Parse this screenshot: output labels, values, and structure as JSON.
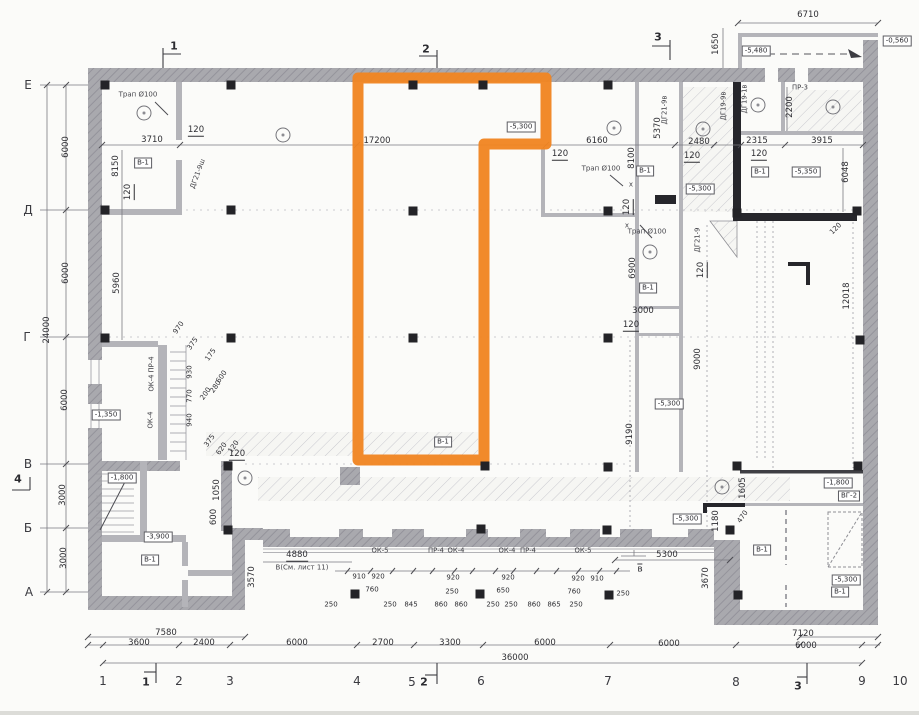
{
  "colors": {
    "paper": "#fbfbf9",
    "wall": "#a8a8ad",
    "wall_dark": "#26262b",
    "line": "#7a7a80",
    "hatch": "#c3c3c9",
    "highlight": "#f08522",
    "ink": "#2e2e33"
  },
  "highlight": {
    "points": "358,78 546,78 546,144 484,144 484,460 358,460"
  },
  "axes": {
    "left": [
      {
        "t": "Е",
        "x": 28,
        "y": 85
      },
      {
        "t": "Д",
        "x": 28,
        "y": 210
      },
      {
        "t": "Г",
        "x": 27,
        "y": 337
      },
      {
        "t": "В",
        "x": 28,
        "y": 464
      },
      {
        "t": "Б",
        "x": 28,
        "y": 528
      },
      {
        "t": "А",
        "x": 29,
        "y": 592
      }
    ],
    "bottom": [
      {
        "t": "1",
        "x": 103,
        "y": 681
      },
      {
        "t": "2",
        "x": 179,
        "y": 681
      },
      {
        "t": "3",
        "x": 230,
        "y": 681
      },
      {
        "t": "4",
        "x": 357,
        "y": 681
      },
      {
        "t": "5",
        "x": 412,
        "y": 682
      },
      {
        "t": "6",
        "x": 481,
        "y": 681
      },
      {
        "t": "7",
        "x": 608,
        "y": 681
      },
      {
        "t": "8",
        "x": 736,
        "y": 682
      },
      {
        "t": "9",
        "x": 862,
        "y": 681
      },
      {
        "t": "10",
        "x": 900,
        "y": 681
      }
    ]
  },
  "labels": [
    {
      "t": "1",
      "x": 174,
      "y": 46,
      "s": "mk"
    },
    {
      "t": "2",
      "x": 426,
      "y": 49,
      "s": "mk"
    },
    {
      "t": "3",
      "x": 658,
      "y": 37,
      "s": "mk"
    },
    {
      "t": "4",
      "x": 18,
      "y": 479,
      "s": "mk"
    },
    {
      "t": "1",
      "x": 146,
      "y": 682,
      "s": "mk"
    },
    {
      "t": "2",
      "x": 424,
      "y": 682,
      "s": "mk"
    },
    {
      "t": "3",
      "x": 798,
      "y": 686,
      "s": "mk"
    },
    {
      "t": "в",
      "x": 640,
      "y": 569,
      "s": "ms"
    },
    {
      "t": "6710",
      "x": 808,
      "y": 15,
      "s": "d"
    },
    {
      "t": "3710",
      "x": 152,
      "y": 140,
      "s": "d"
    },
    {
      "t": "17200",
      "x": 377,
      "y": 141,
      "s": "d"
    },
    {
      "t": "6160",
      "x": 597,
      "y": 141,
      "s": "d"
    },
    {
      "t": "2480",
      "x": 699,
      "y": 142,
      "s": "d"
    },
    {
      "t": "2315",
      "x": 757,
      "y": 141,
      "s": "d"
    },
    {
      "t": "3915",
      "x": 822,
      "y": 141,
      "s": "d"
    },
    {
      "t": "3000",
      "x": 643,
      "y": 311,
      "s": "d"
    },
    {
      "t": "7580",
      "x": 166,
      "y": 633,
      "s": "d"
    },
    {
      "t": "3600",
      "x": 139,
      "y": 643,
      "s": "d"
    },
    {
      "t": "2400",
      "x": 204,
      "y": 643,
      "s": "d"
    },
    {
      "t": "6000",
      "x": 297,
      "y": 643,
      "s": "d"
    },
    {
      "t": "2700",
      "x": 383,
      "y": 643,
      "s": "d"
    },
    {
      "t": "3300",
      "x": 450,
      "y": 643,
      "s": "d"
    },
    {
      "t": "6000",
      "x": 545,
      "y": 643,
      "s": "d"
    },
    {
      "t": "6000",
      "x": 669,
      "y": 644,
      "s": "d"
    },
    {
      "t": "7120",
      "x": 803,
      "y": 634,
      "s": "d"
    },
    {
      "t": "6000",
      "x": 806,
      "y": 646,
      "s": "d"
    },
    {
      "t": "36000",
      "x": 515,
      "y": 658,
      "s": "d"
    },
    {
      "t": "4880",
      "x": 297,
      "y": 556,
      "s": "du"
    },
    {
      "t": "5300",
      "x": 667,
      "y": 555,
      "s": "d"
    },
    {
      "t": "120",
      "x": 196,
      "y": 131,
      "s": "du"
    },
    {
      "t": "120",
      "x": 560,
      "y": 155,
      "s": "du"
    },
    {
      "t": "120",
      "x": 692,
      "y": 157,
      "s": "du"
    },
    {
      "t": "120",
      "x": 759,
      "y": 155,
      "s": "du"
    },
    {
      "t": "120",
      "x": 237,
      "y": 455,
      "s": "du"
    },
    {
      "t": "120",
      "x": 631,
      "y": 326,
      "s": "du"
    },
    {
      "t": "1650",
      "x": 716,
      "y": 44,
      "s": "d",
      "r": -90
    },
    {
      "t": "5370",
      "x": 658,
      "y": 128,
      "s": "d",
      "r": -90
    },
    {
      "t": "8100",
      "x": 632,
      "y": 158,
      "s": "d",
      "r": -90
    },
    {
      "t": "2200",
      "x": 790,
      "y": 107,
      "s": "d",
      "r": -90
    },
    {
      "t": "6048",
      "x": 846,
      "y": 172,
      "s": "d",
      "r": -90
    },
    {
      "t": "8150",
      "x": 116,
      "y": 166,
      "s": "d",
      "r": -90
    },
    {
      "t": "5960",
      "x": 117,
      "y": 283,
      "s": "d",
      "r": -90
    },
    {
      "t": "6000",
      "x": 66,
      "y": 147,
      "s": "d",
      "r": -90
    },
    {
      "t": "6000",
      "x": 66,
      "y": 273,
      "s": "d",
      "r": -90
    },
    {
      "t": "6000",
      "x": 65,
      "y": 400,
      "s": "d",
      "r": -90
    },
    {
      "t": "24000",
      "x": 47,
      "y": 330,
      "s": "d",
      "r": -90
    },
    {
      "t": "3000",
      "x": 63,
      "y": 495,
      "s": "d",
      "r": -90
    },
    {
      "t": "3000",
      "x": 64,
      "y": 558,
      "s": "d",
      "r": -90
    },
    {
      "t": "6900",
      "x": 633,
      "y": 268,
      "s": "d",
      "r": -90
    },
    {
      "t": "9190",
      "x": 630,
      "y": 434,
      "s": "d",
      "r": -90
    },
    {
      "t": "12018",
      "x": 847,
      "y": 296,
      "s": "d",
      "r": -90
    },
    {
      "t": "9000",
      "x": 698,
      "y": 359,
      "s": "d",
      "r": -90
    },
    {
      "t": "1050",
      "x": 217,
      "y": 490,
      "s": "d",
      "r": -90
    },
    {
      "t": "600",
      "x": 214,
      "y": 517,
      "s": "d",
      "r": -90
    },
    {
      "t": "3570",
      "x": 252,
      "y": 577,
      "s": "d",
      "r": -90
    },
    {
      "t": "3670",
      "x": 706,
      "y": 578,
      "s": "d",
      "r": -90
    },
    {
      "t": "1180",
      "x": 716,
      "y": 521,
      "s": "d",
      "r": -90
    },
    {
      "t": "1605",
      "x": 743,
      "y": 488,
      "s": "d",
      "r": -90
    },
    {
      "t": "120",
      "x": 129,
      "y": 192,
      "s": "du",
      "r": -90
    },
    {
      "t": "120",
      "x": 628,
      "y": 207,
      "s": "du",
      "r": -90
    },
    {
      "t": "120",
      "x": 702,
      "y": 270,
      "s": "du",
      "r": -90
    },
    {
      "t": "970",
      "x": 179,
      "y": 328,
      "s": "d7",
      "r": -55
    },
    {
      "t": "375",
      "x": 193,
      "y": 344,
      "s": "d7",
      "r": -55
    },
    {
      "t": "175",
      "x": 211,
      "y": 355,
      "s": "d7",
      "r": -55
    },
    {
      "t": "600",
      "x": 222,
      "y": 377,
      "s": "d7",
      "r": -55
    },
    {
      "t": "200",
      "x": 206,
      "y": 394,
      "s": "d7",
      "r": -55
    },
    {
      "t": "280",
      "x": 216,
      "y": 387,
      "s": "d7",
      "r": -55
    },
    {
      "t": "930",
      "x": 190,
      "y": 372,
      "s": "d7",
      "r": -90
    },
    {
      "t": "770",
      "x": 190,
      "y": 396,
      "s": "d7",
      "r": -90
    },
    {
      "t": "940",
      "x": 190,
      "y": 420,
      "s": "d7",
      "r": -90
    },
    {
      "t": "375",
      "x": 210,
      "y": 441,
      "s": "d7",
      "r": -55
    },
    {
      "t": "620",
      "x": 222,
      "y": 449,
      "s": "d7",
      "r": -55
    },
    {
      "t": "120",
      "x": 234,
      "y": 447,
      "s": "d7",
      "r": -55
    },
    {
      "t": "470",
      "x": 743,
      "y": 517,
      "s": "d7",
      "r": -55
    },
    {
      "t": "120",
      "x": 836,
      "y": 229,
      "s": "d7",
      "r": -45
    },
    {
      "t": "910",
      "x": 359,
      "y": 577,
      "s": "d7"
    },
    {
      "t": "920",
      "x": 378,
      "y": 577,
      "s": "d7"
    },
    {
      "t": "920",
      "x": 453,
      "y": 578,
      "s": "d7"
    },
    {
      "t": "920",
      "x": 508,
      "y": 578,
      "s": "d7"
    },
    {
      "t": "920",
      "x": 578,
      "y": 579,
      "s": "d7"
    },
    {
      "t": "910",
      "x": 597,
      "y": 579,
      "s": "d7"
    },
    {
      "t": "760",
      "x": 372,
      "y": 590,
      "s": "d7"
    },
    {
      "t": "250",
      "x": 452,
      "y": 592,
      "s": "d7"
    },
    {
      "t": "650",
      "x": 503,
      "y": 591,
      "s": "d7"
    },
    {
      "t": "760",
      "x": 574,
      "y": 592,
      "s": "d7"
    },
    {
      "t": "250",
      "x": 623,
      "y": 594,
      "s": "d7"
    },
    {
      "t": "250",
      "x": 331,
      "y": 605,
      "s": "d7"
    },
    {
      "t": "250",
      "x": 390,
      "y": 605,
      "s": "d7"
    },
    {
      "t": "845",
      "x": 411,
      "y": 605,
      "s": "d7"
    },
    {
      "t": "860",
      "x": 441,
      "y": 605,
      "s": "d7"
    },
    {
      "t": "860",
      "x": 461,
      "y": 605,
      "s": "d7"
    },
    {
      "t": "250",
      "x": 493,
      "y": 605,
      "s": "d7"
    },
    {
      "t": "250",
      "x": 511,
      "y": 605,
      "s": "d7"
    },
    {
      "t": "860",
      "x": 534,
      "y": 605,
      "s": "d7"
    },
    {
      "t": "865",
      "x": 554,
      "y": 605,
      "s": "d7"
    },
    {
      "t": "250",
      "x": 576,
      "y": 605,
      "s": "d7"
    },
    {
      "t": "ОК-5",
      "x": 380,
      "y": 551,
      "s": "w"
    },
    {
      "t": "ПР-4",
      "x": 436,
      "y": 551,
      "s": "w"
    },
    {
      "t": "ОК-4",
      "x": 456,
      "y": 551,
      "s": "w"
    },
    {
      "t": "ОК-4",
      "x": 507,
      "y": 551,
      "s": "w"
    },
    {
      "t": "ПР-4",
      "x": 528,
      "y": 551,
      "s": "w"
    },
    {
      "t": "ОК-5",
      "x": 583,
      "y": 551,
      "s": "w"
    },
    {
      "t": "ОК-4 ПР-4",
      "x": 152,
      "y": 374,
      "s": "w",
      "r": -90
    },
    {
      "t": "ОК-4",
      "x": 151,
      "y": 420,
      "s": "w",
      "r": -90
    },
    {
      "t": "ДГ21-9ш",
      "x": 198,
      "y": 174,
      "s": "w",
      "r": -70
    },
    {
      "t": "ДГ21-9в",
      "x": 665,
      "y": 110,
      "s": "w",
      "r": -90
    },
    {
      "t": "ДГ19-9в",
      "x": 724,
      "y": 106,
      "s": "w",
      "r": -90
    },
    {
      "t": "ДГ21-9",
      "x": 698,
      "y": 240,
      "s": "w",
      "r": -90
    },
    {
      "t": "ДГ19-1в",
      "x": 745,
      "y": 99,
      "s": "w",
      "r": -90
    },
    {
      "t": "ПР-3",
      "x": 800,
      "y": 88,
      "s": "w"
    },
    {
      "t": "Трап Ø100",
      "x": 138,
      "y": 95,
      "s": "n"
    },
    {
      "t": "Трап Ø100",
      "x": 601,
      "y": 169,
      "s": "n"
    },
    {
      "t": "Трап Ø100",
      "x": 647,
      "y": 232,
      "s": "n"
    },
    {
      "t": "В(См. лист 11)",
      "x": 302,
      "y": 568,
      "s": "n"
    },
    {
      "t": "х",
      "x": 631,
      "y": 185,
      "s": "n"
    },
    {
      "t": "х",
      "x": 627,
      "y": 226,
      "s": "n"
    },
    {
      "t": "В-1",
      "x": 143,
      "y": 163,
      "s": "rm"
    },
    {
      "t": "В-1",
      "x": 645,
      "y": 171,
      "s": "rm"
    },
    {
      "t": "В-1",
      "x": 760,
      "y": 172,
      "s": "rm"
    },
    {
      "t": "В-1",
      "x": 648,
      "y": 288,
      "s": "rm"
    },
    {
      "t": "В-1",
      "x": 443,
      "y": 442,
      "s": "rm"
    },
    {
      "t": "В-1",
      "x": 762,
      "y": 550,
      "s": "rm"
    },
    {
      "t": "В-1",
      "x": 840,
      "y": 592,
      "s": "rm"
    },
    {
      "t": "В-1",
      "x": 150,
      "y": 560,
      "s": "rm"
    },
    {
      "t": "ВГ-2",
      "x": 849,
      "y": 496,
      "s": "rm"
    },
    {
      "t": "-5,480",
      "x": 756,
      "y": 51,
      "s": "lv"
    },
    {
      "t": "-0,560",
      "x": 897,
      "y": 41,
      "s": "lv"
    },
    {
      "t": "-5,300",
      "x": 521,
      "y": 127,
      "s": "lv"
    },
    {
      "t": "-5,300",
      "x": 700,
      "y": 189,
      "s": "lv"
    },
    {
      "t": "-5,350",
      "x": 806,
      "y": 172,
      "s": "lv"
    },
    {
      "t": "-5,300",
      "x": 669,
      "y": 404,
      "s": "lv"
    },
    {
      "t": "-5,300",
      "x": 687,
      "y": 519,
      "s": "lv"
    },
    {
      "t": "-1,350",
      "x": 106,
      "y": 415,
      "s": "lv"
    },
    {
      "t": "-1,800",
      "x": 122,
      "y": 478,
      "s": "lv"
    },
    {
      "t": "-3,900",
      "x": 158,
      "y": 537,
      "s": "lv"
    },
    {
      "t": "-1,800",
      "x": 838,
      "y": 483,
      "s": "lv"
    },
    {
      "t": "-5,300",
      "x": 846,
      "y": 580,
      "s": "lv"
    }
  ],
  "circled_marks": [
    [
      144,
      113
    ],
    [
      283,
      135
    ],
    [
      614,
      128
    ],
    [
      703,
      129
    ],
    [
      758,
      105
    ],
    [
      833,
      107
    ],
    [
      650,
      252
    ],
    [
      245,
      478
    ],
    [
      722,
      487
    ]
  ],
  "columns": [
    [
      105,
      85
    ],
    [
      231,
      85
    ],
    [
      413,
      85
    ],
    [
      483,
      85
    ],
    [
      608,
      85
    ],
    [
      105,
      210
    ],
    [
      231,
      210
    ],
    [
      413,
      211
    ],
    [
      608,
      211
    ],
    [
      737,
      213
    ],
    [
      857,
      211
    ],
    [
      105,
      338
    ],
    [
      231,
      338
    ],
    [
      413,
      338
    ],
    [
      608,
      338
    ],
    [
      860,
      340
    ],
    [
      228,
      466
    ],
    [
      485,
      466
    ],
    [
      608,
      467
    ],
    [
      737,
      466
    ],
    [
      858,
      466
    ],
    [
      228,
      530
    ],
    [
      481,
      529
    ],
    [
      607,
      530
    ],
    [
      730,
      530
    ],
    [
      355,
      594
    ],
    [
      480,
      594
    ],
    [
      609,
      595
    ],
    [
      738,
      595
    ]
  ]
}
